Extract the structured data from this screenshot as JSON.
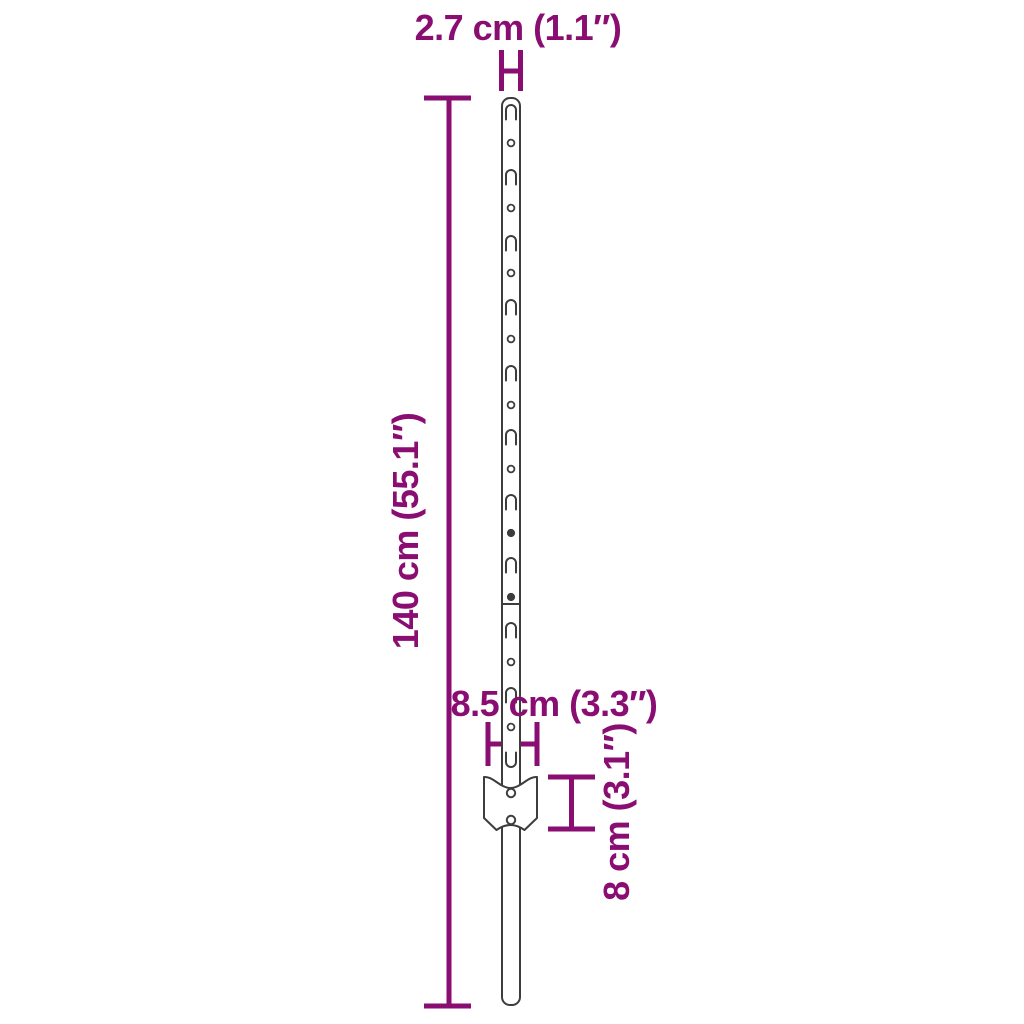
{
  "diagram": {
    "title": "U-post with anchor plate — dimension diagram",
    "labels": {
      "post_width": "2.7 cm (1.1″)",
      "post_height": "140 cm (55.1″)",
      "plate_width": "8.5 cm (3.3″)",
      "plate_height": "8 cm (3.1″)"
    },
    "colors": {
      "dimension": "#8A0D72",
      "outline": "#3D3D3D",
      "background": "#FFFFFF"
    },
    "post": {
      "slot_count": 10,
      "hole_count": 8,
      "bolt_hole_count": 2,
      "features": [
        {
          "type": "slot",
          "y": 112
        },
        {
          "type": "hole",
          "y": 143
        },
        {
          "type": "slot",
          "y": 177
        },
        {
          "type": "hole",
          "y": 208
        },
        {
          "type": "slot",
          "y": 243
        },
        {
          "type": "hole",
          "y": 273
        },
        {
          "type": "slot",
          "y": 307
        },
        {
          "type": "hole",
          "y": 339
        },
        {
          "type": "slot",
          "y": 373
        },
        {
          "type": "hole",
          "y": 405
        },
        {
          "type": "slot",
          "y": 437
        },
        {
          "type": "hole",
          "y": 469
        },
        {
          "type": "slot",
          "y": 502
        },
        {
          "type": "bolt",
          "y": 533
        },
        {
          "type": "slot",
          "y": 565
        },
        {
          "type": "bolt",
          "y": 597
        },
        {
          "type": "slot",
          "y": 630
        },
        {
          "type": "hole",
          "y": 662
        },
        {
          "type": "slot",
          "y": 695
        },
        {
          "type": "hole",
          "y": 727
        },
        {
          "type": "uslot",
          "y": 760
        }
      ],
      "seam_y": 604,
      "plate_holes_y": [
        793,
        820
      ]
    }
  }
}
